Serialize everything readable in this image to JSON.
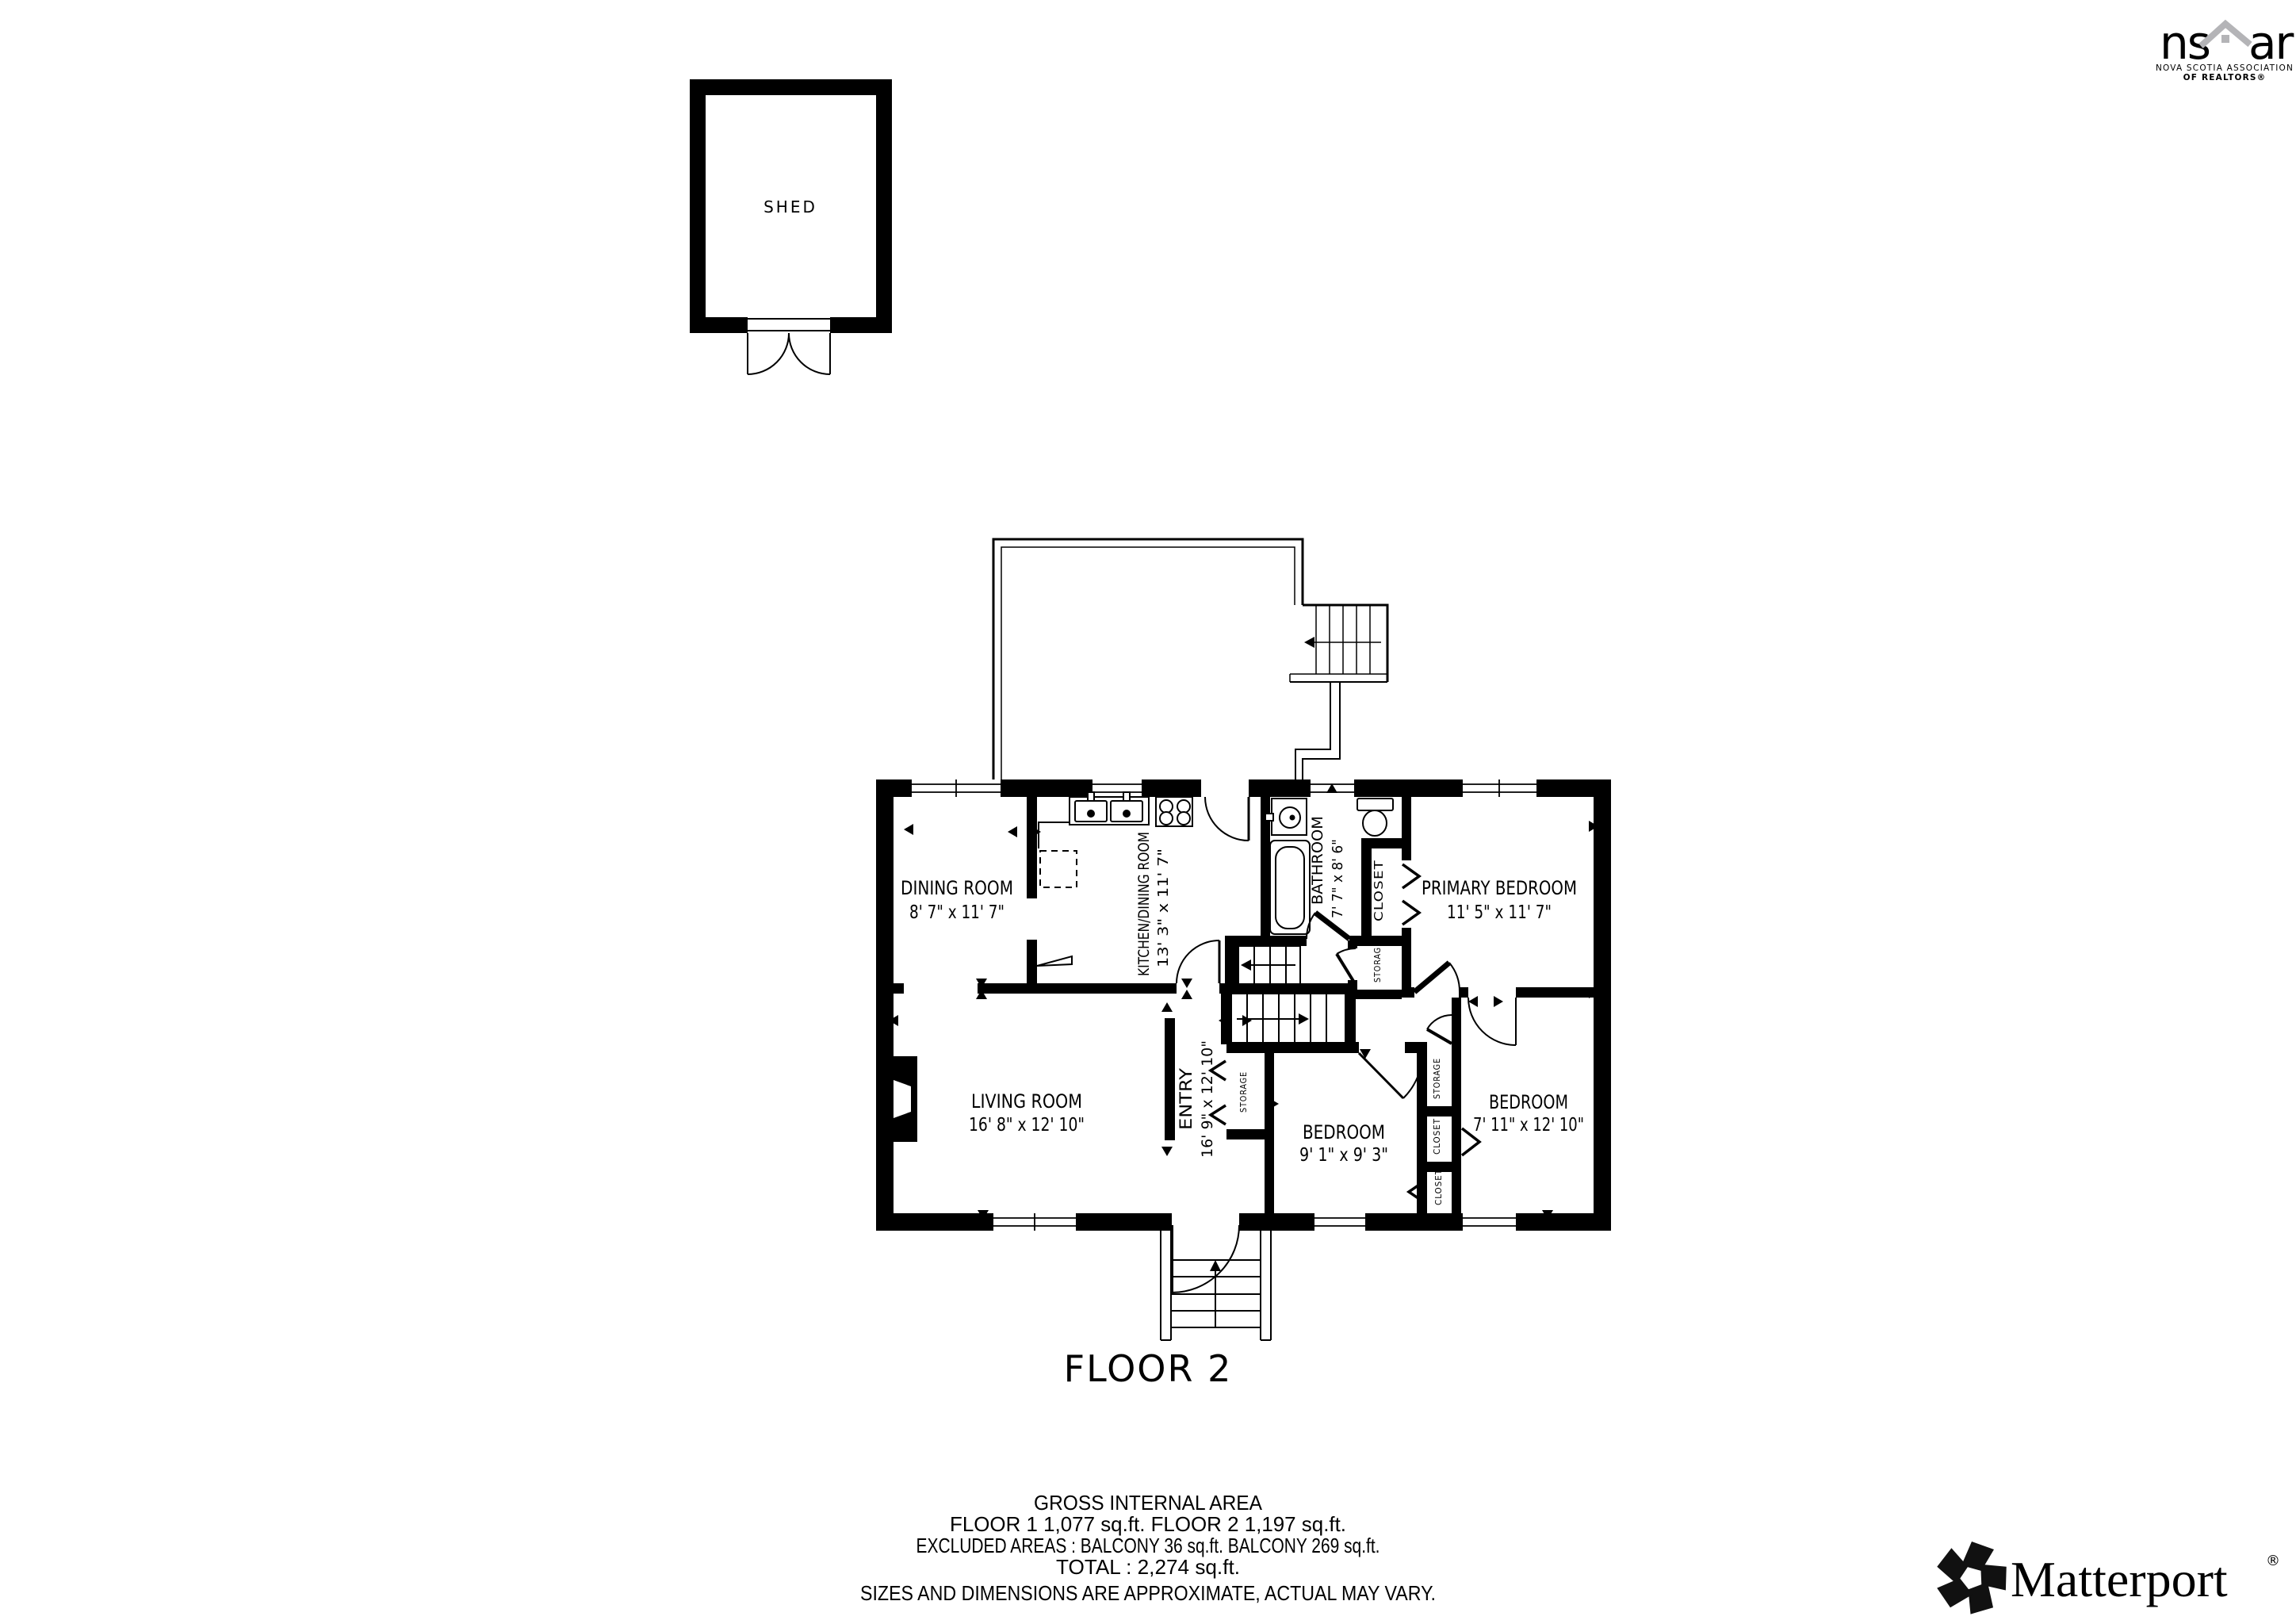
{
  "colors": {
    "wall": "#000000",
    "line": "#000000",
    "disclaimer_gray": "#7b7b7b",
    "logo_gray": "#b4b4b7",
    "ink": "#111111"
  },
  "shed": {
    "label": "SHED"
  },
  "floor_plan": {
    "floor_label": "FLOOR 2",
    "rooms": {
      "dining": {
        "name": "DINING ROOM",
        "dims": "8' 7\" x 11' 7\""
      },
      "kitchen": {
        "name": "KITCHEN/DINING ROOM",
        "dims": "13' 3\" x 11' 7\""
      },
      "bathroom": {
        "name": "BATHROOM",
        "dims": "7' 7\" x 8' 6\""
      },
      "primary_bedroom": {
        "name": "PRIMARY BEDROOM",
        "dims": "11' 5\" x 11' 7\""
      },
      "living": {
        "name": "LIVING ROOM",
        "dims": "16' 8\" x 12' 10\""
      },
      "entry": {
        "name": "ENTRY",
        "dims": "16' 9\" x 12' 10\""
      },
      "bedroom_small": {
        "name": "BEDROOM",
        "dims": "9' 1\" x 9' 3\""
      },
      "bedroom_right": {
        "name": "BEDROOM",
        "dims": "7' 11\" x 12' 10\""
      }
    },
    "closets": {
      "closet_bathroom": "CLOSET",
      "storage_hall": "STORAGE",
      "storage_entry": "STORAGE",
      "storage_column": "STORAGE",
      "closet_middle": "CLOSET",
      "closet_bottom": "CLOSET"
    }
  },
  "summary": {
    "title": "GROSS INTERNAL AREA",
    "line1": "FLOOR 1 1,077 sq.ft.   FLOOR 2 1,197 sq.ft.",
    "line2": "EXCLUDED AREAS :  BALCONY 36 sq.ft.   BALCONY 269 sq.ft.",
    "line3": "TOTAL :  2,274 sq.ft.",
    "disclaimer": "SIZES AND DIMENSIONS ARE APPROXIMATE, ACTUAL MAY VARY."
  },
  "nsar_logo": {
    "word_left": "ns",
    "word_right": "ar",
    "tagline_line1": "NOVA SCOTIA ASSOCIATION",
    "tagline_line2": "OF REALTORS®"
  },
  "matterport_logo": {
    "wordmark": "Matterport",
    "registered_mark": "®"
  }
}
